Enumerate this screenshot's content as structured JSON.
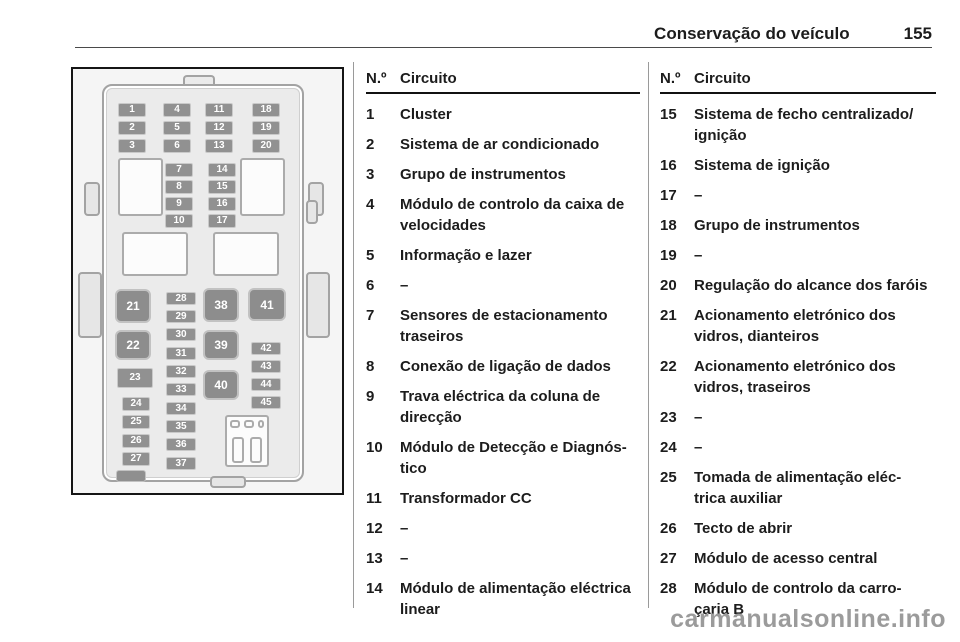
{
  "page": {
    "section_title": "Conservação do veículo",
    "page_number": "155",
    "watermark": "carmanualsonline.info"
  },
  "table": {
    "header_num": "N.º",
    "header_circuit": "Circuito",
    "columns": [
      {
        "rows": [
          {
            "num": "1",
            "lines": [
              "Cluster"
            ]
          },
          {
            "num": "2",
            "lines": [
              "Sistema de ar condicionado"
            ]
          },
          {
            "num": "3",
            "lines": [
              "Grupo de instrumentos"
            ]
          },
          {
            "num": "4",
            "lines": [
              "Módulo de controlo da caixa de",
              "velocidades"
            ]
          },
          {
            "num": "5",
            "lines": [
              "Informação e lazer"
            ]
          },
          {
            "num": "6",
            "lines": [
              "–"
            ]
          },
          {
            "num": "7",
            "lines": [
              "Sensores de estacionamento",
              "traseiros"
            ]
          },
          {
            "num": "8",
            "lines": [
              "Conexão de ligação de dados"
            ]
          },
          {
            "num": "9",
            "lines": [
              "Trava eléctrica da coluna de",
              "direcção"
            ]
          },
          {
            "num": "10",
            "lines": [
              "Módulo de Detecção e Diagnós-",
              "tico"
            ]
          },
          {
            "num": "11",
            "lines": [
              "Transformador CC"
            ]
          },
          {
            "num": "12",
            "lines": [
              "–"
            ]
          },
          {
            "num": "13",
            "lines": [
              "–"
            ]
          },
          {
            "num": "14",
            "lines": [
              "Módulo de alimentação eléctrica",
              "linear"
            ]
          }
        ]
      },
      {
        "rows": [
          {
            "num": "15",
            "lines": [
              "Sistema de fecho centralizado/",
              "ignição"
            ]
          },
          {
            "num": "16",
            "lines": [
              "Sistema de ignição"
            ]
          },
          {
            "num": "17",
            "lines": [
              "–"
            ]
          },
          {
            "num": "18",
            "lines": [
              "Grupo de instrumentos"
            ]
          },
          {
            "num": "19",
            "lines": [
              "–"
            ]
          },
          {
            "num": "20",
            "lines": [
              "Regulação do alcance dos faróis"
            ]
          },
          {
            "num": "21",
            "lines": [
              "Acionamento eletrónico dos",
              "vidros, dianteiros"
            ]
          },
          {
            "num": "22",
            "lines": [
              "Acionamento eletrónico dos",
              "vidros, traseiros"
            ]
          },
          {
            "num": "23",
            "lines": [
              "–"
            ]
          },
          {
            "num": "24",
            "lines": [
              "–"
            ]
          },
          {
            "num": "25",
            "lines": [
              "Tomada de alimentação eléc-",
              "trica auxiliar"
            ]
          },
          {
            "num": "26",
            "lines": [
              "Tecto de abrir"
            ]
          },
          {
            "num": "27",
            "lines": [
              "Módulo de acesso central"
            ]
          },
          {
            "num": "28",
            "lines": [
              "Módulo de controlo da carro-",
              "çaria B"
            ]
          }
        ]
      }
    ]
  },
  "diagram": {
    "fuses": [
      {
        "n": "1",
        "x": 42,
        "y": 31,
        "w": 28,
        "h": 14
      },
      {
        "n": "2",
        "x": 42,
        "y": 49,
        "w": 28,
        "h": 14
      },
      {
        "n": "3",
        "x": 42,
        "y": 67,
        "w": 28,
        "h": 14
      },
      {
        "n": "4",
        "x": 87,
        "y": 31,
        "w": 28,
        "h": 14
      },
      {
        "n": "5",
        "x": 87,
        "y": 49,
        "w": 28,
        "h": 14
      },
      {
        "n": "6",
        "x": 87,
        "y": 67,
        "w": 28,
        "h": 14
      },
      {
        "n": "11",
        "x": 129,
        "y": 31,
        "w": 28,
        "h": 14
      },
      {
        "n": "12",
        "x": 129,
        "y": 49,
        "w": 28,
        "h": 14
      },
      {
        "n": "13",
        "x": 129,
        "y": 67,
        "w": 28,
        "h": 14
      },
      {
        "n": "18",
        "x": 176,
        "y": 31,
        "w": 28,
        "h": 14
      },
      {
        "n": "19",
        "x": 176,
        "y": 49,
        "w": 28,
        "h": 14
      },
      {
        "n": "20",
        "x": 176,
        "y": 67,
        "w": 28,
        "h": 14
      },
      {
        "n": "7",
        "x": 89,
        "y": 91,
        "w": 28,
        "h": 14
      },
      {
        "n": "8",
        "x": 89,
        "y": 108,
        "w": 28,
        "h": 14
      },
      {
        "n": "9",
        "x": 89,
        "y": 125,
        "w": 28,
        "h": 14
      },
      {
        "n": "10",
        "x": 89,
        "y": 142,
        "w": 28,
        "h": 14
      },
      {
        "n": "14",
        "x": 132,
        "y": 91,
        "w": 28,
        "h": 14
      },
      {
        "n": "15",
        "x": 132,
        "y": 108,
        "w": 28,
        "h": 14
      },
      {
        "n": "16",
        "x": 132,
        "y": 125,
        "w": 28,
        "h": 14
      },
      {
        "n": "17",
        "x": 132,
        "y": 142,
        "w": 28,
        "h": 14
      },
      {
        "n": "23",
        "x": 41,
        "y": 296,
        "w": 36,
        "h": 20
      },
      {
        "n": "24",
        "x": 46,
        "y": 325,
        "w": 28,
        "h": 14
      },
      {
        "n": "25",
        "x": 46,
        "y": 343,
        "w": 28,
        "h": 14
      },
      {
        "n": "26",
        "x": 46,
        "y": 362,
        "w": 28,
        "h": 14
      },
      {
        "n": "27",
        "x": 46,
        "y": 380,
        "w": 28,
        "h": 14
      },
      {
        "n": "28",
        "x": 90,
        "y": 220,
        "w": 30,
        "h": 13
      },
      {
        "n": "29",
        "x": 90,
        "y": 238,
        "w": 30,
        "h": 13
      },
      {
        "n": "30",
        "x": 90,
        "y": 256,
        "w": 30,
        "h": 13
      },
      {
        "n": "31",
        "x": 90,
        "y": 275,
        "w": 30,
        "h": 13
      },
      {
        "n": "32",
        "x": 90,
        "y": 293,
        "w": 30,
        "h": 13
      },
      {
        "n": "33",
        "x": 90,
        "y": 311,
        "w": 30,
        "h": 13
      },
      {
        "n": "34",
        "x": 90,
        "y": 330,
        "w": 30,
        "h": 13
      },
      {
        "n": "35",
        "x": 90,
        "y": 348,
        "w": 30,
        "h": 13
      },
      {
        "n": "36",
        "x": 90,
        "y": 366,
        "w": 30,
        "h": 13
      },
      {
        "n": "37",
        "x": 90,
        "y": 385,
        "w": 30,
        "h": 13
      },
      {
        "n": "42",
        "x": 175,
        "y": 270,
        "w": 30,
        "h": 13
      },
      {
        "n": "43",
        "x": 175,
        "y": 288,
        "w": 30,
        "h": 13
      },
      {
        "n": "44",
        "x": 175,
        "y": 306,
        "w": 30,
        "h": 13
      },
      {
        "n": "45",
        "x": 175,
        "y": 324,
        "w": 30,
        "h": 13
      }
    ],
    "relays": [
      {
        "n": "21",
        "x": 39,
        "y": 217,
        "w": 36,
        "h": 34
      },
      {
        "n": "22",
        "x": 39,
        "y": 258,
        "w": 36,
        "h": 30
      },
      {
        "n": "38",
        "x": 127,
        "y": 216,
        "w": 36,
        "h": 34
      },
      {
        "n": "39",
        "x": 127,
        "y": 258,
        "w": 36,
        "h": 30
      },
      {
        "n": "40",
        "x": 127,
        "y": 298,
        "w": 36,
        "h": 30
      },
      {
        "n": "41",
        "x": 172,
        "y": 216,
        "w": 38,
        "h": 33
      }
    ],
    "boxes": [
      {
        "x": 42,
        "y": 86,
        "w": 45,
        "h": 58
      },
      {
        "x": 164,
        "y": 86,
        "w": 45,
        "h": 58
      },
      {
        "x": 46,
        "y": 160,
        "w": 66,
        "h": 44
      },
      {
        "x": 137,
        "y": 160,
        "w": 66,
        "h": 44
      },
      {
        "x": 149,
        "y": 343,
        "w": 44,
        "h": 52
      },
      {
        "x": 156,
        "y": 365,
        "w": 12,
        "h": 26
      },
      {
        "x": 174,
        "y": 365,
        "w": 12,
        "h": 26
      },
      {
        "x": 154,
        "y": 348,
        "w": 10,
        "h": 8
      },
      {
        "x": 168,
        "y": 348,
        "w": 10,
        "h": 8
      },
      {
        "x": 182,
        "y": 348,
        "w": 6,
        "h": 8
      }
    ],
    "clips": [
      {
        "x": 8,
        "y": 110,
        "w": 16,
        "h": 34
      },
      {
        "x": 2,
        "y": 200,
        "w": 24,
        "h": 66
      },
      {
        "x": 232,
        "y": 110,
        "w": 16,
        "h": 34
      },
      {
        "x": 230,
        "y": 200,
        "w": 24,
        "h": 66
      },
      {
        "x": 230,
        "y": 128,
        "w": 12,
        "h": 24
      },
      {
        "x": 134,
        "y": 404,
        "w": 36,
        "h": 12
      }
    ],
    "solids": [
      {
        "x": 40,
        "y": 398,
        "w": 30,
        "h": 12
      }
    ]
  }
}
